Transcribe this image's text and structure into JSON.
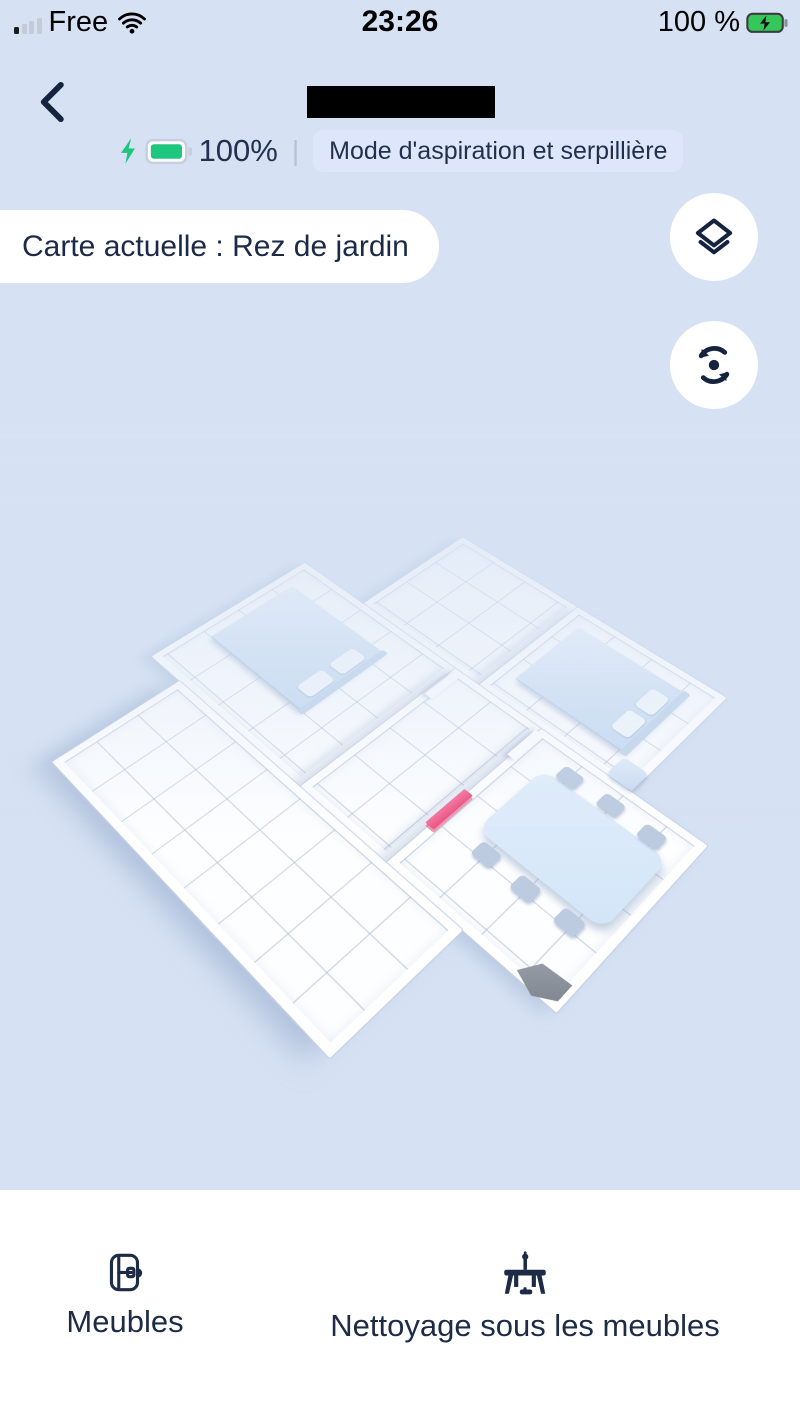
{
  "status_bar": {
    "carrier": "Free",
    "time": "23:26",
    "battery_percent": "100 %"
  },
  "header": {
    "battery_label": "100%",
    "divider": "|",
    "mode_label": "Mode d'aspiration et serpillière"
  },
  "map": {
    "current_map_label": "Carte actuelle : Rez de jardin",
    "controls": [
      "layers",
      "rotate"
    ],
    "furniture": [
      "bed-left",
      "bed-right",
      "nightstand",
      "dining-table",
      "dining-chairs",
      "pink-door",
      "dock-ramp"
    ]
  },
  "bottom_bar": {
    "items": [
      {
        "icon": "furniture-icon",
        "label": "Meubles"
      },
      {
        "icon": "clean-under-furniture-icon",
        "label": "Nettoyage sous les meubles"
      }
    ]
  },
  "colors": {
    "background": "#d6e2f4",
    "navy_text": "#1d2b49",
    "mode_pill_bg": "#dde6fa",
    "battery_green": "#1ec77d",
    "door_pink": "#ee4f80",
    "panel_white": "#ffffff"
  }
}
